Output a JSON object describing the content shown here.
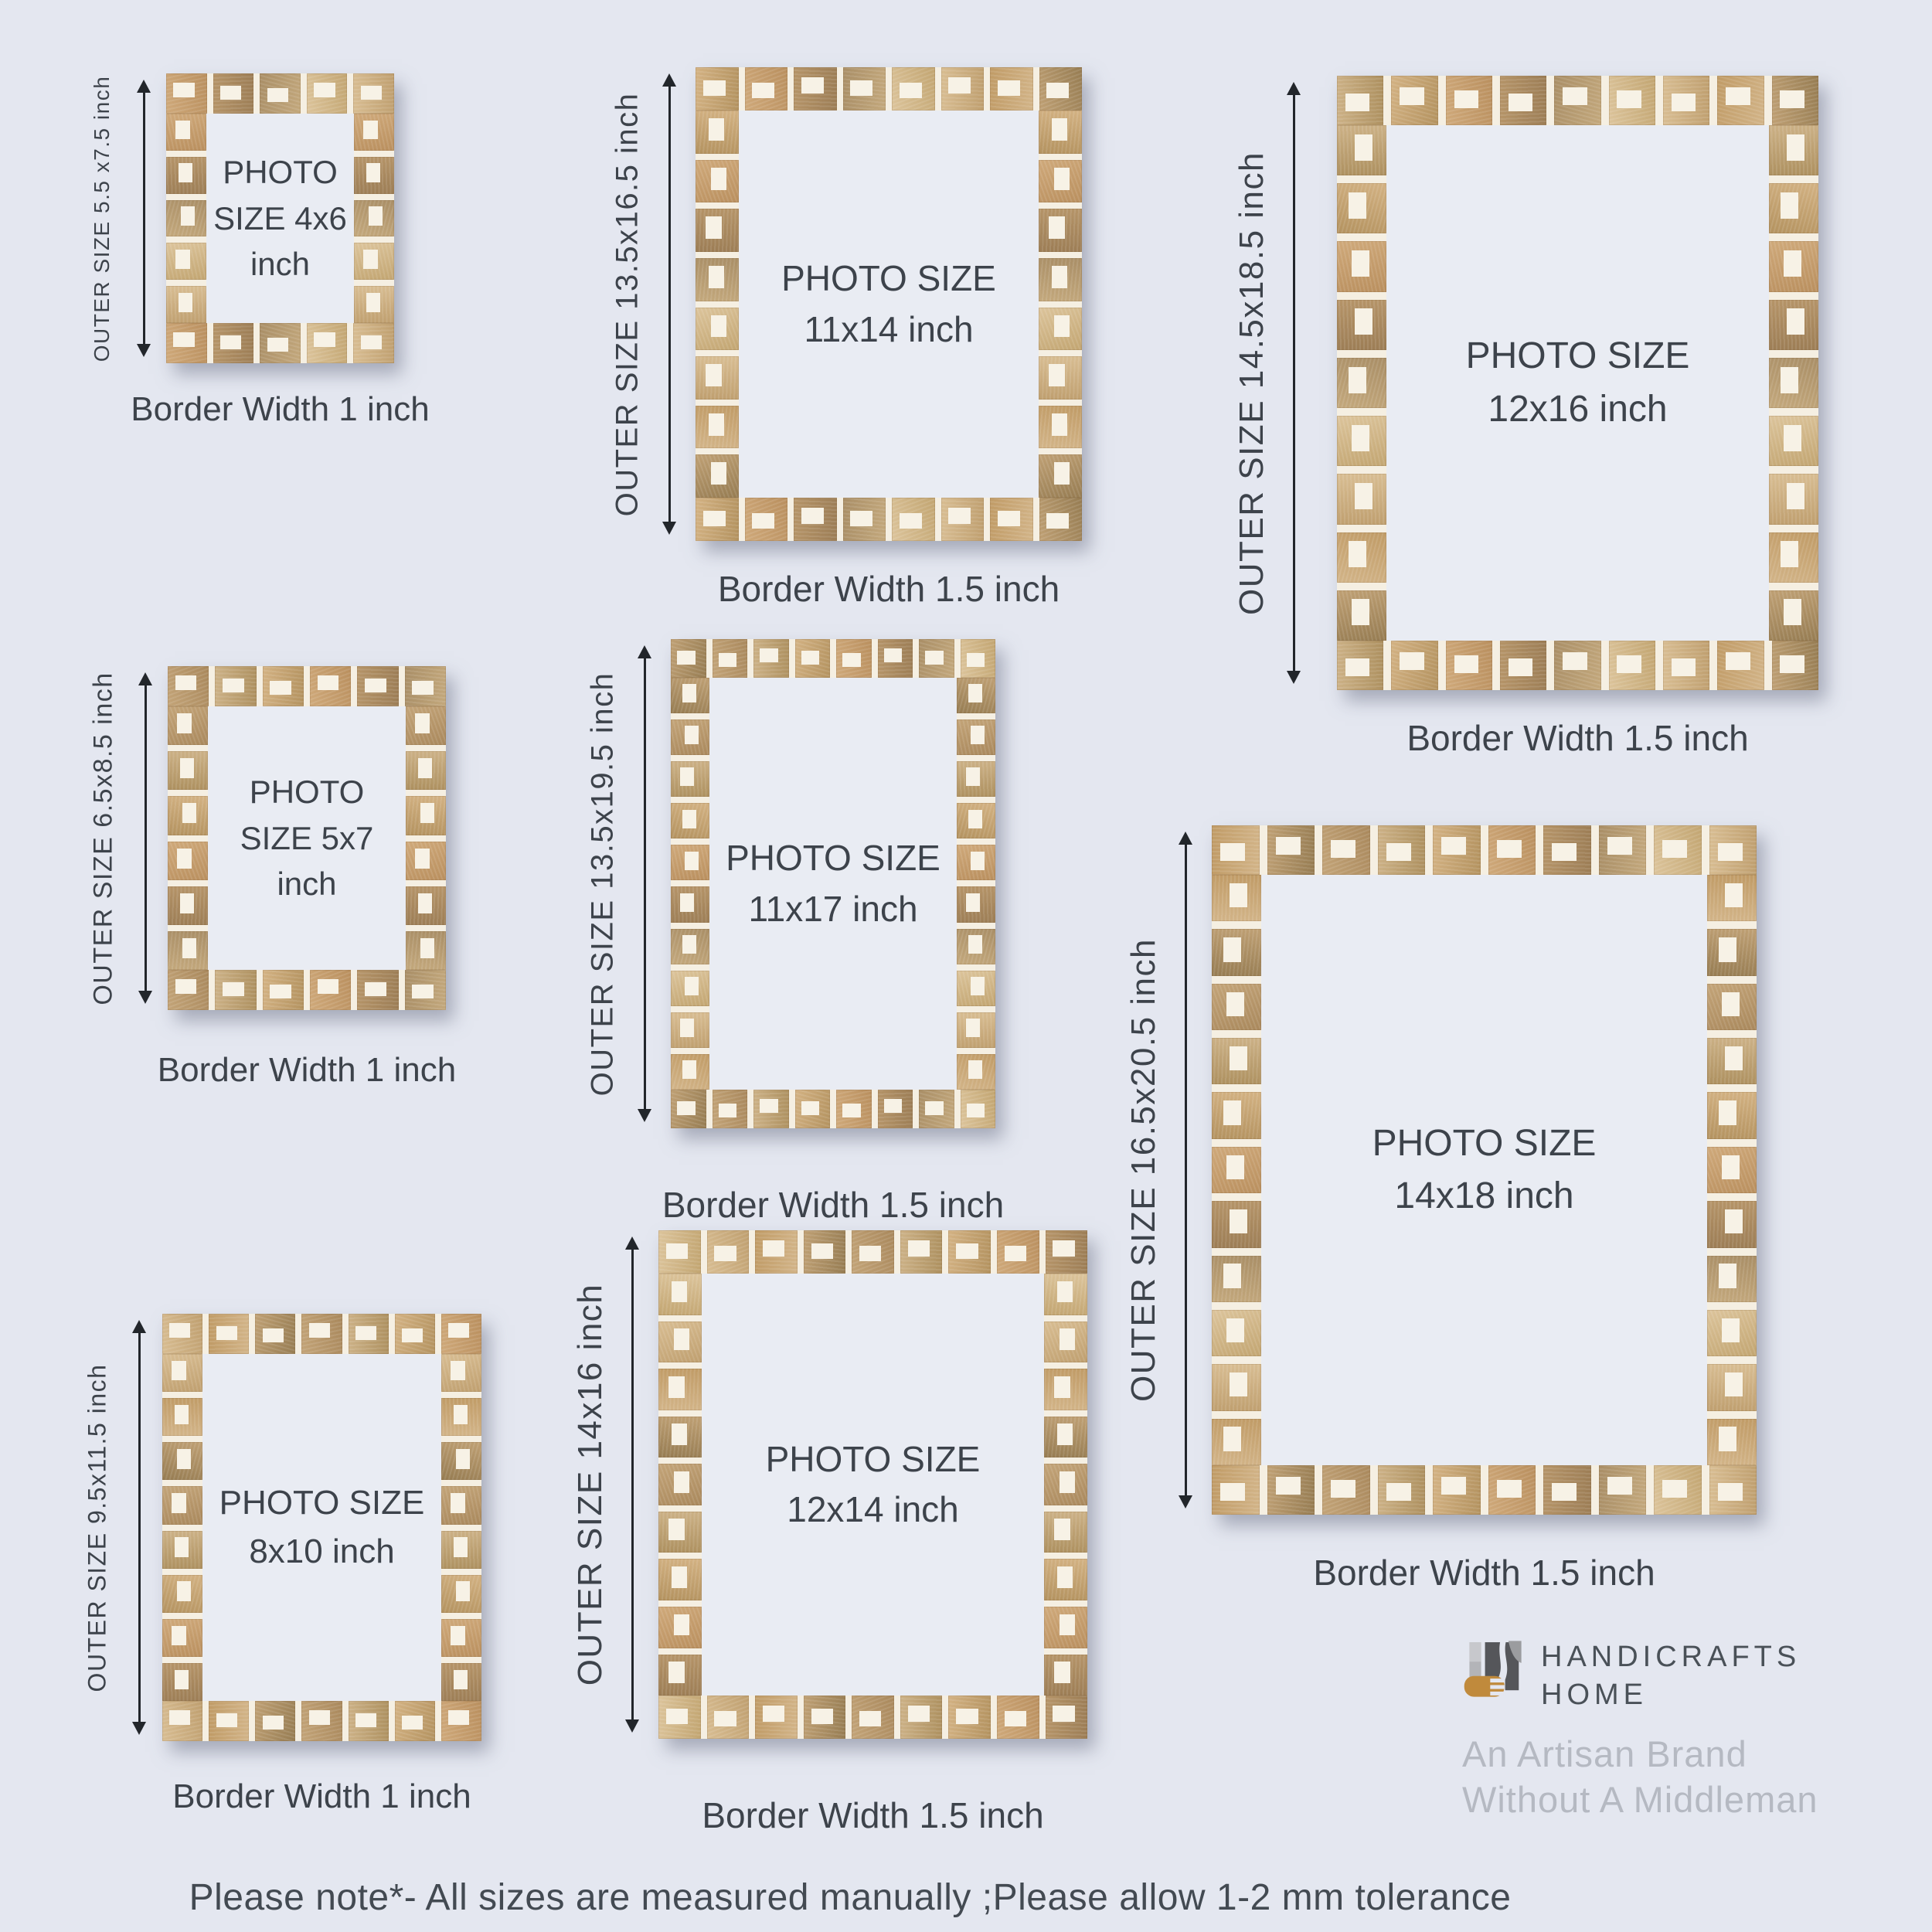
{
  "page": {
    "note": "Please note*-  All sizes are measured manually ;Please allow 1-2 mm tolerance"
  },
  "frames": [
    {
      "outer_label": "OUTER SIZE 5.5 x7.5 inch",
      "photo_lines": [
        "PHOTO",
        "SIZE 4x6",
        "inch"
      ],
      "border_label": "Border Width 1 inch"
    },
    {
      "outer_label": "OUTER SIZE 13.5x16.5 inch",
      "photo_lines": [
        "PHOTO SIZE",
        "11x14 inch"
      ],
      "border_label": "Border Width 1.5 inch"
    },
    {
      "outer_label": "OUTER SIZE 14.5x18.5 inch",
      "photo_lines": [
        "PHOTO SIZE",
        "12x16 inch"
      ],
      "border_label": "Border Width 1.5 inch"
    },
    {
      "outer_label": "OUTER SIZE 6.5x8.5 inch",
      "photo_lines": [
        "PHOTO",
        "SIZE 5x7",
        "inch"
      ],
      "border_label": "Border Width 1 inch"
    },
    {
      "outer_label": "OUTER SIZE 13.5x19.5 inch",
      "photo_lines": [
        "PHOTO SIZE",
        "11x17 inch"
      ],
      "border_label": "Border Width 1.5 inch"
    },
    {
      "outer_label": "OUTER SIZE 16.5x20.5 inch",
      "photo_lines": [
        "PHOTO SIZE",
        "14x18 inch"
      ],
      "border_label": "Border Width 1.5 inch"
    },
    {
      "outer_label": "OUTER SIZE 9.5x11.5 inch",
      "photo_lines": [
        "PHOTO SIZE",
        "8x10 inch"
      ],
      "border_label": "Border Width 1 inch"
    },
    {
      "outer_label": "OUTER SIZE 14x16 inch",
      "photo_lines": [
        "PHOTO SIZE",
        "12x14 inch"
      ],
      "border_label": "Border Width 1.5 inch"
    }
  ],
  "brand": {
    "name_line1": "HANDICRAFTS",
    "name_line2": "HOME",
    "tagline_line1": "An Artisan Brand",
    "tagline_line2": "Without A Middleman"
  },
  "colors": {
    "background": "#e4e7f0",
    "photo_window": "#e9ecf3",
    "label_text": "#3d434b",
    "bone_inlay_white": "#f5efe2",
    "wood_light": "#d8bd92",
    "wood_dark": "#9c7d55",
    "arrow_black": "#22262b",
    "brand_text_gray": "#4a5158",
    "tagline_gray": "#b5b9c2",
    "logo_gold": "#c08a3c",
    "logo_charcoal": "#55565a",
    "logo_silver": "#b3b4b8"
  }
}
